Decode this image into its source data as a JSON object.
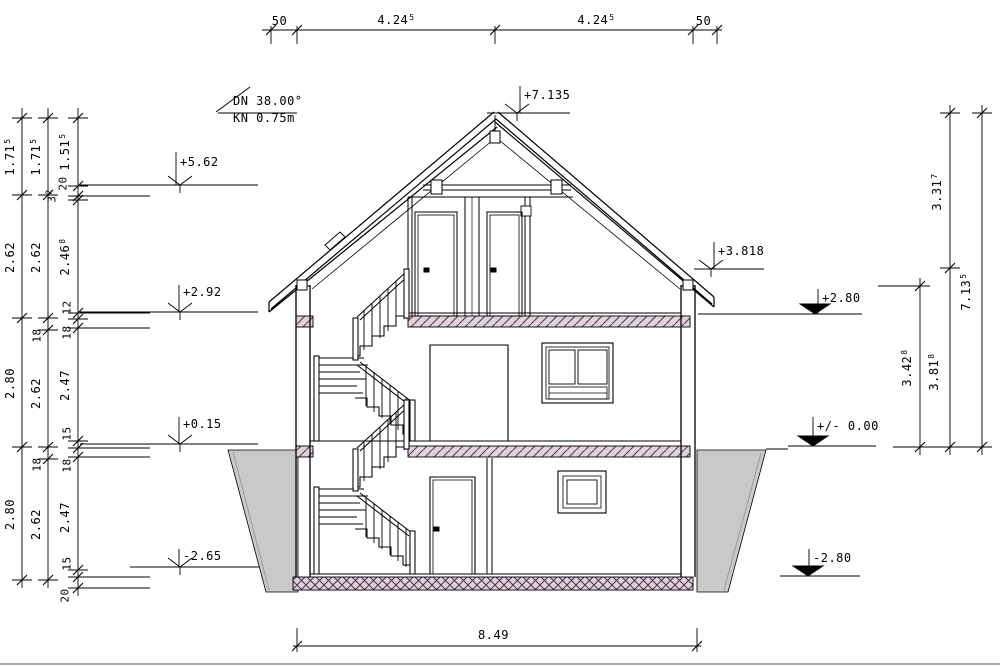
{
  "annotations": {
    "roof_pitch": "DN 38.00°",
    "knee_wall": "KN 0.75m"
  },
  "top_dims": [
    {
      "main": "50",
      "sup": ""
    },
    {
      "main": "4.24",
      "sup": "5"
    },
    {
      "main": "4.24",
      "sup": "5"
    },
    {
      "main": "50",
      "sup": ""
    }
  ],
  "bottom_dim": {
    "main": "8.49",
    "sup": ""
  },
  "levels": {
    "ridge": "+7.135",
    "attic_top": "+5.62",
    "eaves": "+3.818",
    "attic_floor_fin": "+2.92",
    "attic_floor_raw": "+2.80",
    "ground_floor_fin": "+0.15",
    "ground_zero": "+/- 0.00",
    "basement_fin": "-2.65",
    "basement_raw": "-2.80"
  },
  "left_chains": {
    "outer": [
      {
        "main": "1.71",
        "sup": "5"
      },
      {
        "main": "2.62",
        "sup": ""
      },
      {
        "main": "2.80",
        "sup": ""
      },
      {
        "main": "2.80",
        "sup": ""
      }
    ],
    "middle": [
      {
        "main": "1.71",
        "sup": "5"
      },
      {
        "main": "2.62",
        "sup": ""
      },
      {
        "main": "18",
        "sup": ""
      },
      {
        "main": "2.62",
        "sup": ""
      },
      {
        "main": "18",
        "sup": ""
      },
      {
        "main": "2.62",
        "sup": ""
      }
    ],
    "inner": [
      {
        "main": "1.51",
        "sup": "5"
      },
      {
        "main": "20",
        "sup": ""
      },
      {
        "main": "3",
        "sup": "2"
      },
      {
        "main": "2.46",
        "sup": "8"
      },
      {
        "main": "12",
        "sup": ""
      },
      {
        "main": "18",
        "sup": ""
      },
      {
        "main": "2.47",
        "sup": ""
      },
      {
        "main": "15",
        "sup": ""
      },
      {
        "main": "18",
        "sup": ""
      },
      {
        "main": "2.47",
        "sup": ""
      },
      {
        "main": "15",
        "sup": ""
      },
      {
        "main": "20",
        "sup": ""
      }
    ]
  },
  "right_chains": {
    "inner": [
      {
        "main": "3.42",
        "sup": "8"
      }
    ],
    "middle": [
      {
        "main": "3.31",
        "sup": "7"
      },
      {
        "main": "3.81",
        "sup": "8"
      }
    ],
    "outer": [
      {
        "main": "7.13",
        "sup": "5"
      }
    ]
  },
  "colors": {
    "line": "#000000",
    "earth_fill": "#c9c9c9",
    "slab_fill": "#d9d5d9",
    "hatch": "#6e2a58"
  }
}
